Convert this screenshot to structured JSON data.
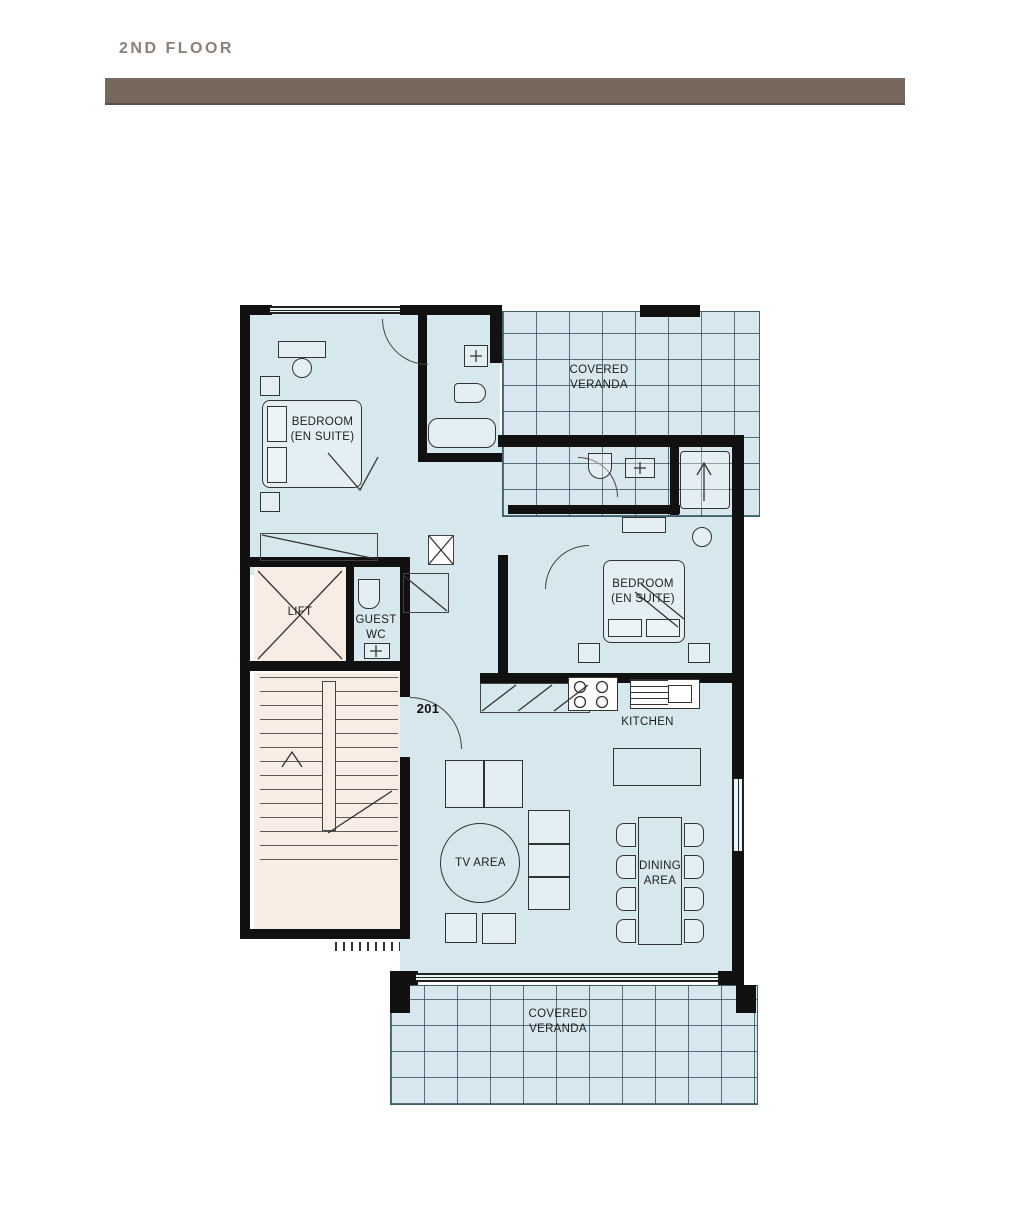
{
  "header": {
    "title": "2ND FLOOR"
  },
  "unit": {
    "number": "201"
  },
  "rooms": {
    "bedroom1": {
      "line1": "BEDROOM",
      "line2": "(EN SUITE)"
    },
    "bedroom2": {
      "line1": "BEDROOM",
      "line2": "(EN SUITE)"
    },
    "veranda_top": {
      "line1": "COVERED",
      "line2": "VERANDA"
    },
    "veranda_bottom": {
      "line1": "COVERED",
      "line2": "VERANDA"
    },
    "lift": {
      "label": "LIFT"
    },
    "guest_wc": {
      "line1": "GUEST",
      "line2": "WC"
    },
    "kitchen": {
      "label": "KITCHEN"
    },
    "tv_area": {
      "label": "TV AREA"
    },
    "dining_area": {
      "line1": "DINING",
      "line2": "AREA"
    }
  },
  "colors": {
    "header_bar": "#76685c",
    "header_text": "#8a8178",
    "floor_fill": "#d6e7ed",
    "stair_lift_fill": "#f9ece4",
    "wall": "#111111"
  }
}
